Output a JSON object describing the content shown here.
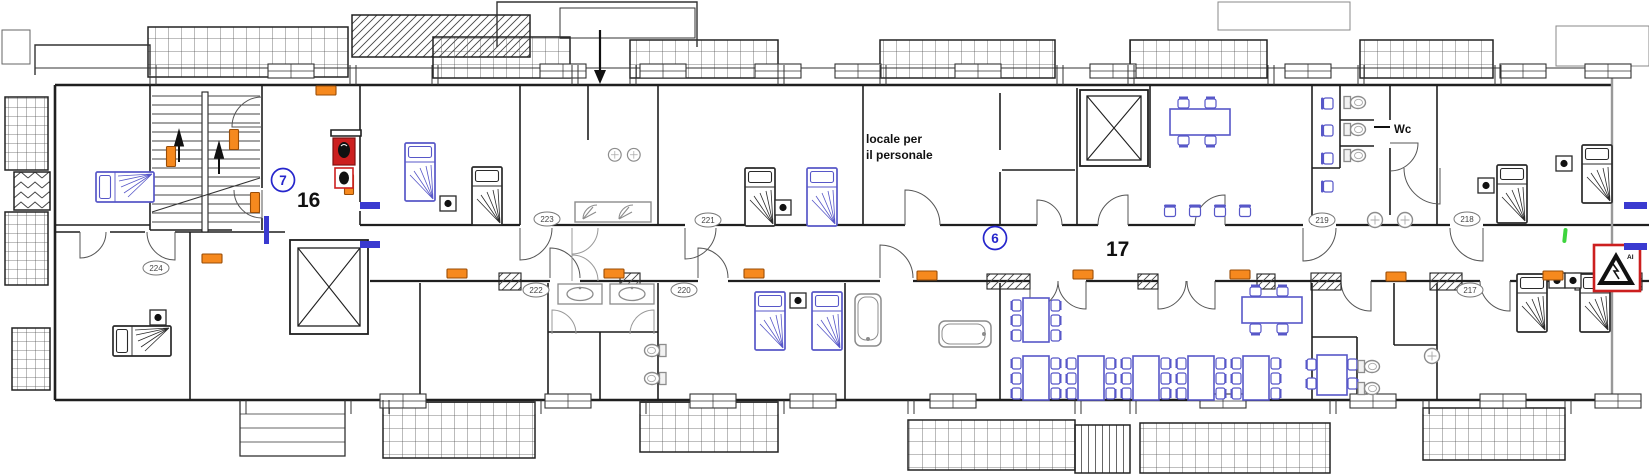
{
  "plan": {
    "kind": "hotel-floor-plan",
    "corridor": {
      "left_zone_badge": "7",
      "left_zone_number": "16",
      "right_zone_badge": "6",
      "right_zone_number": "17"
    },
    "rooms": [
      {
        "number": "224"
      },
      {
        "number": "223"
      },
      {
        "number": "222"
      },
      {
        "number": "221"
      },
      {
        "number": "220"
      },
      {
        "number": "219"
      },
      {
        "number": "218"
      },
      {
        "number": "217"
      }
    ],
    "texts": {
      "staff_room_line1": "locale per",
      "staff_room_line2": "il personale",
      "wc": "Wc",
      "warning_sign_text": "AI"
    },
    "colors": {
      "wall": "#1f1f1f",
      "furniture_blue": "#5757c8",
      "fixture_gray": "#8c8c8c",
      "marker_orange": "#f6891e",
      "safety_red": "#cc1f1f",
      "badge_blue": "#2626cc",
      "check_green": "#3ed43e"
    },
    "symbols": [
      {
        "name": "emergency-light-marker",
        "count": 14
      },
      {
        "name": "fire-hydrant-box",
        "count": 1
      },
      {
        "name": "fire-extinguisher-box",
        "count": 1
      },
      {
        "name": "hazard-warning-sign",
        "count": 1
      },
      {
        "name": "inspection-check-mark",
        "count": 1
      },
      {
        "name": "elevator-shaft",
        "count": 2
      },
      {
        "name": "staircase",
        "count": 1
      }
    ]
  }
}
